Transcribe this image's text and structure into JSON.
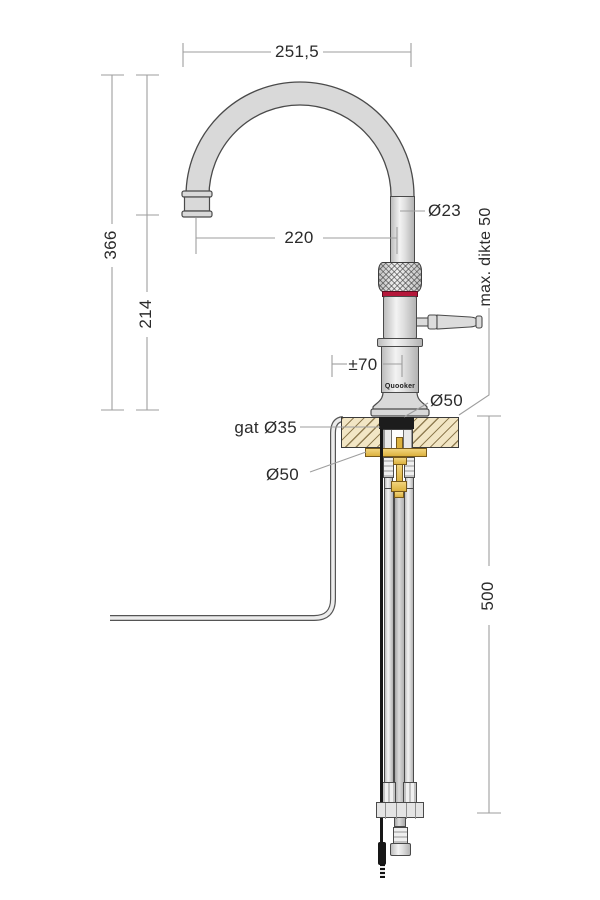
{
  "drawing_title": "tap-dimension-diagram",
  "labels": {
    "top_width": "251,5",
    "height_total": "366",
    "height_outlet": "214",
    "reach": "220",
    "spout_dia": "Ø23",
    "max_thickness": "max. dikte 50",
    "swivel": "±70",
    "brand": "Quooker",
    "base_dia": "Ø50",
    "hole_dia": "gat Ø35",
    "flange_dia": "Ø50",
    "under_depth": "500"
  },
  "colors": {
    "background": "#ffffff",
    "outline": "#4a4a4a",
    "dim_line": "#9e9e9e",
    "text": "#2b2b2b",
    "metal_light": "#d9d9d9",
    "accent_red": "#b5173a",
    "brass": "#e3bd55",
    "counter_fill": "#f2e6c5",
    "counter_hatch_line": "#8c784d",
    "cable_black": "#171717"
  }
}
